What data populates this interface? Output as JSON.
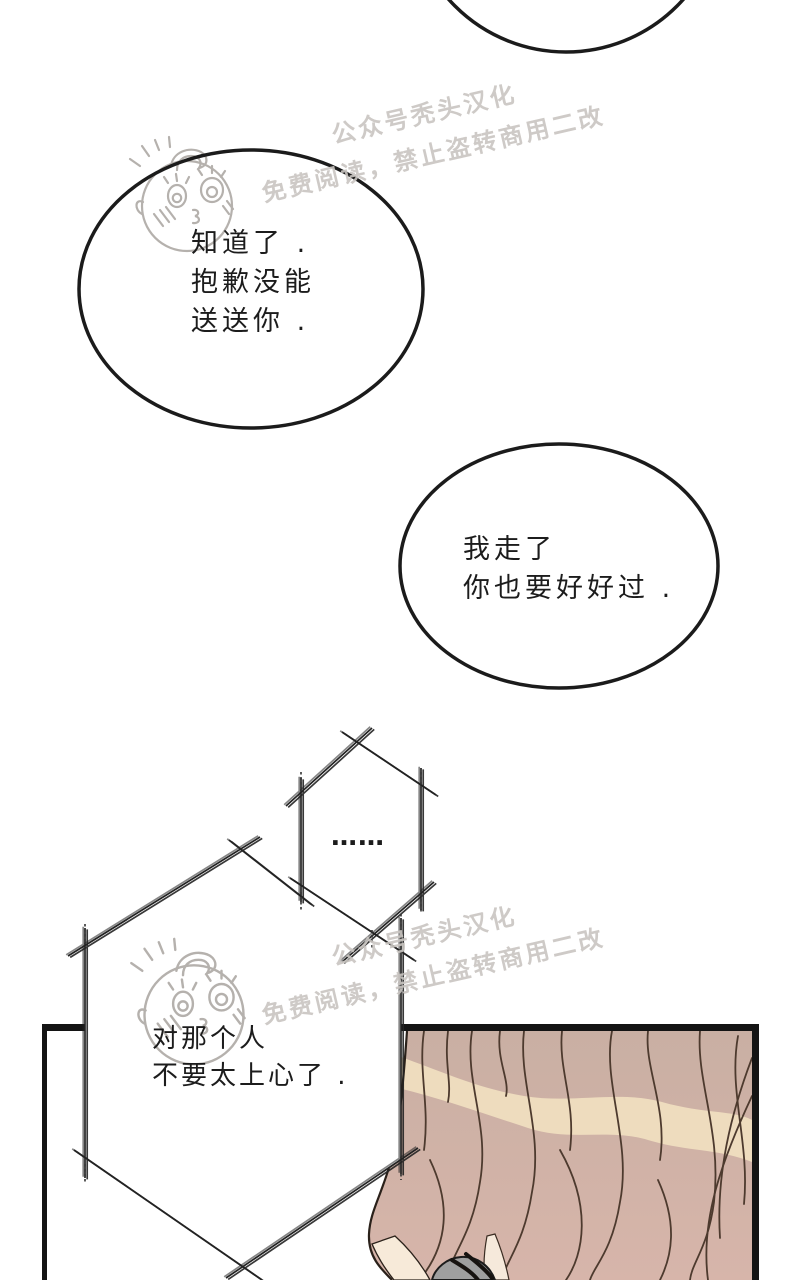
{
  "page": {
    "type": "comic-page",
    "background": "#ffffff"
  },
  "watermark": {
    "line1": "公众号秃头汉化",
    "line2": "免费阅读，禁止盗转商用二改",
    "color": "#c9c5c1"
  },
  "dialogue": {
    "bubble1": {
      "line1": "知道了 .",
      "line2": "抱歉没能",
      "line3": "送送你 ."
    },
    "bubble2": {
      "line1": "我走了",
      "line2": "你也要好好过 ."
    },
    "thought_small": {
      "dots": "……"
    },
    "thought_big": {
      "line1": "对那个人",
      "line2": "不要太上心了 ."
    }
  },
  "colors": {
    "line_black": "#141414",
    "bubble_stroke": "#1b1b1b",
    "sketch_stroke": "#232323",
    "doodle_gray": "#b5b1ad",
    "hair_base": "#c9afa3",
    "hair_base_bottom": "#d7b5aa",
    "hair_highlight": "#eedcbe",
    "hair_strand": "#4d3a2e",
    "skin": "#f7ead9",
    "collar_grey": "#9f9f9f"
  }
}
